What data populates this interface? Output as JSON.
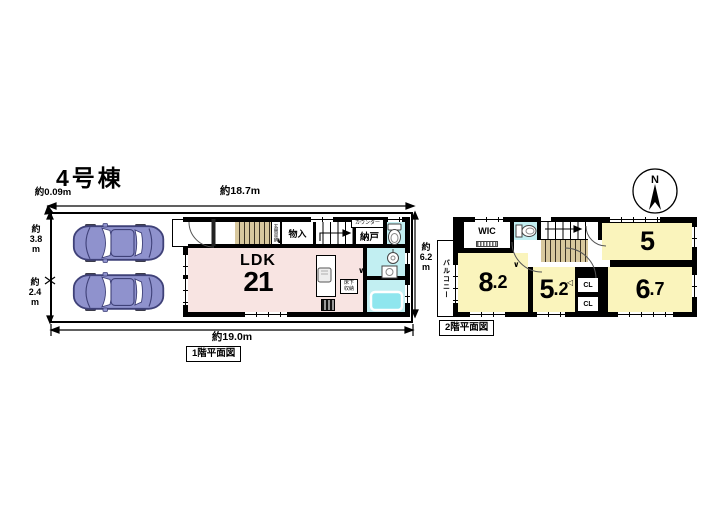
{
  "title": "4号棟",
  "floor1": {
    "caption": "1階平面図",
    "dims": {
      "offset": "約0.09m",
      "top": "約18.7m",
      "left_upper": "約\n3.8\nm",
      "left_lower": "約\n2.4\nm",
      "bottom": "約19.0m",
      "right": "約\n6.2\nm"
    },
    "rooms": {
      "ldk": "LDK",
      "ldk_size": "21",
      "monoire": "物入",
      "counter": "カウンター",
      "nando": "納戸",
      "yukashita": "床下\n収納",
      "genkan_storage": "玄関収納"
    }
  },
  "floor2": {
    "caption": "2階平面図",
    "compass_n": "N",
    "balcony": "バルコニー",
    "rooms": {
      "wic": "WIC",
      "r5": "5",
      "r82_i": "8",
      "r82_d": ".2",
      "r52_i": "5",
      "r52_d": ".2",
      "r67_i": "6",
      "r67_d": ".7",
      "cl_upper": "CL",
      "cl_lower": "CL"
    }
  },
  "symbols": {
    "door_v": "∨",
    "tri_left": "◁",
    "tri_right": "▷"
  },
  "colors": {
    "wall": "#000000",
    "ldk_pink": "#F8E4E2",
    "room_yellow": "#FAF4BC",
    "wet_cyan": "#C2EFF2",
    "stair_tan": "#D8C89E",
    "car_body": "#8F92CD"
  }
}
